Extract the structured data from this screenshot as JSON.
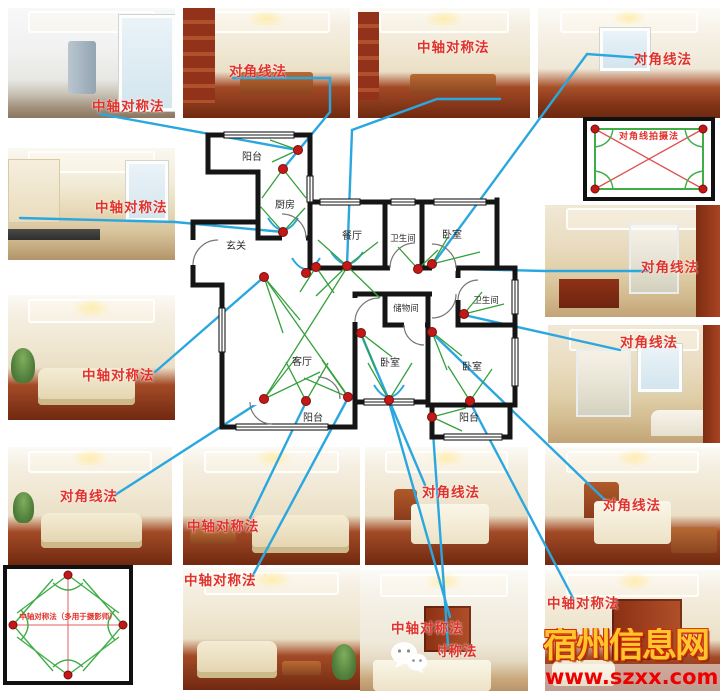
{
  "annotations": {
    "labels": [
      {
        "text": "中轴对称法"
      },
      {
        "text": "对角线法"
      },
      {
        "text": "中轴对称法"
      },
      {
        "text": "对角线法"
      },
      {
        "text": "中轴对称法"
      },
      {
        "text": "对角线法"
      },
      {
        "text": "中轴对称法"
      },
      {
        "text": "对角线法"
      },
      {
        "text": "对角线法"
      },
      {
        "text": "中轴对称法"
      },
      {
        "text": "对角线法"
      },
      {
        "text": "对角线法"
      },
      {
        "text": "中轴对称法"
      },
      {
        "text": "中轴对称法"
      },
      {
        "text": "中轴对称法"
      },
      {
        "text": "中轴对称法"
      }
    ]
  },
  "plan": {
    "rooms": [
      {
        "name": "阳台"
      },
      {
        "name": "厨房"
      },
      {
        "name": "玄关"
      },
      {
        "name": "餐厅"
      },
      {
        "name": "卫生间"
      },
      {
        "name": "卧室"
      },
      {
        "name": "储物间"
      },
      {
        "name": "卫生间"
      },
      {
        "name": "客厅"
      },
      {
        "name": "卧室"
      },
      {
        "name": "卧室"
      },
      {
        "name": "阳台"
      },
      {
        "name": "阳台"
      }
    ]
  },
  "diagrams": {
    "diagonal": {
      "title": "对角线拍摄法"
    },
    "symmetry": {
      "title": "中轴对称法（多用于摄影师）"
    }
  },
  "photos": [
    {
      "subject": "enclosed-balcony-laundry"
    },
    {
      "subject": "dining-room-with-bookshelf"
    },
    {
      "subject": "dining-room"
    },
    {
      "subject": "empty-bedroom"
    },
    {
      "subject": "kitchen"
    },
    {
      "subject": "bathroom-with-shower"
    },
    {
      "subject": "living-room-sofa"
    },
    {
      "subject": "bathroom-with-tub"
    },
    {
      "subject": "living-room"
    },
    {
      "subject": "living-room"
    },
    {
      "subject": "living-room"
    },
    {
      "subject": "bedroom-with-teddy"
    },
    {
      "subject": "kids-bedroom"
    },
    {
      "subject": "bedroom"
    },
    {
      "subject": "bedroom-with-wardrobe"
    }
  ],
  "watermark": {
    "site_name": "宿州信息网",
    "site_url": "www.szxx.com.cn"
  },
  "colors": {
    "label_red": "#e0322a",
    "connector_blue": "#2ba7e0",
    "fov_green": "#3fae49",
    "camera_dot_red": "#c21818",
    "wall_black": "#151515",
    "watermark_gold": "#ffc62e",
    "watermark_url_red": "#ee0000"
  }
}
